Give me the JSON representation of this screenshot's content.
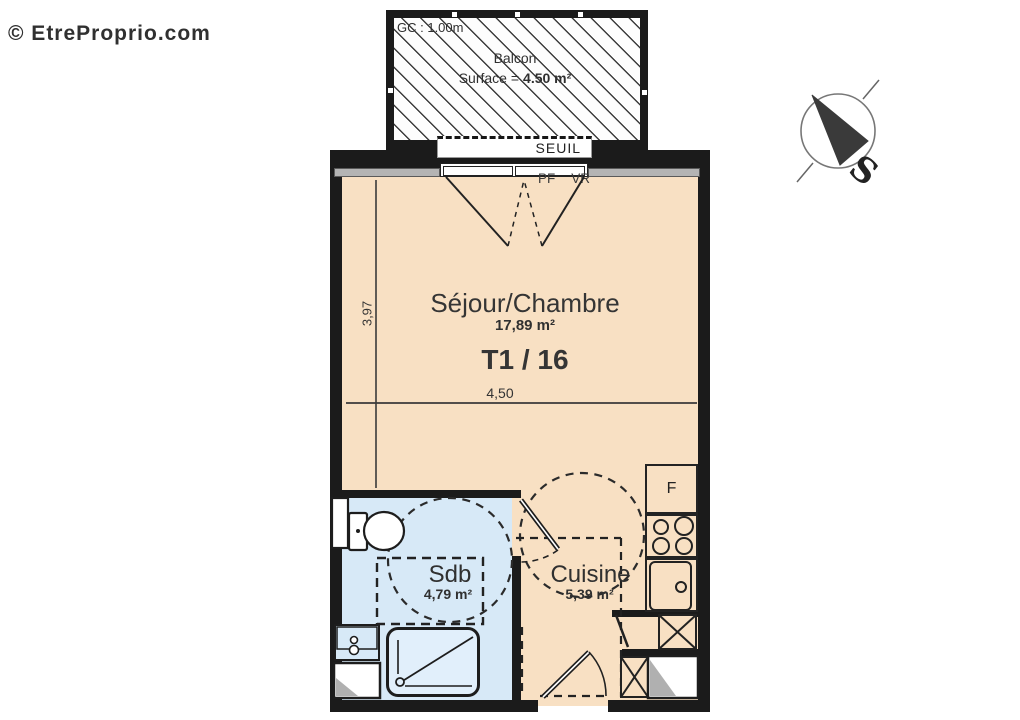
{
  "watermark": "© EtreProprio.com",
  "compass": {
    "south": "S"
  },
  "balcony": {
    "gc": "GC : 1.00m",
    "name": "Balcon",
    "surface_label": "Surface =",
    "surface_value": "4.50 m²",
    "threshold": "SEUIL"
  },
  "window": {
    "pf": "PF",
    "vr": "VR"
  },
  "living_room": {
    "name": "Séjour/Chambre",
    "area": "17,89 m²",
    "unit": "T1 / 16",
    "width_m": "4,50",
    "depth_m": "3,97"
  },
  "bathroom": {
    "name": "Sdb",
    "area": "4,79 m²"
  },
  "kitchen": {
    "name": "Cuisine",
    "area": "5,39 m²",
    "fridge": "F"
  },
  "colors": {
    "floor": "#f8e0c3",
    "bathroom_floor": "#d7e9f7",
    "wall": "#1b1b1b",
    "hatch_line": "#3c3c3c"
  }
}
